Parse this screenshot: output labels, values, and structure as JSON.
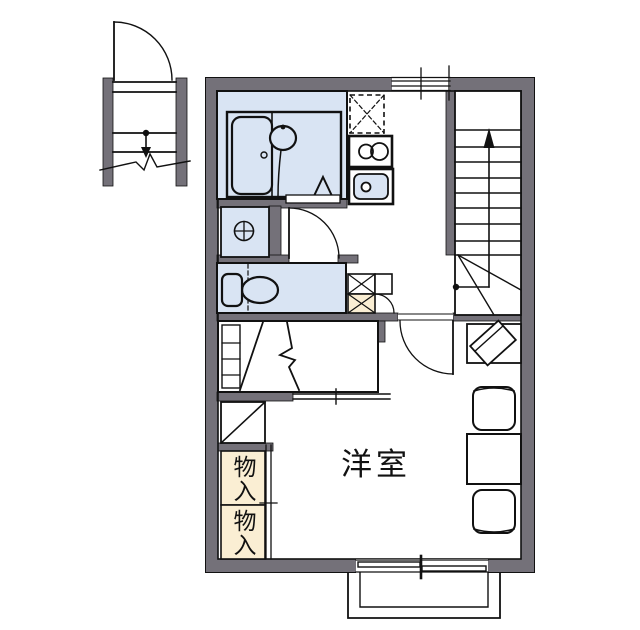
{
  "plan": {
    "labels": {
      "main_room": "洋室",
      "storage_upper": "物入",
      "storage_lower": "物入"
    },
    "colors": {
      "wall": "#747179",
      "wet_area": "#d9e4f3",
      "storage": "#faeed3",
      "line": "#111111",
      "background": "#ffffff"
    },
    "symbols": [
      "exterior-staircase-down-arrow",
      "entry-door-swing",
      "bathtub",
      "washbasin",
      "bath-triangle-symbol",
      "refrigerator-space-dashed",
      "two-burner-stove",
      "kitchen-sink",
      "washing-machine-pan",
      "toilet",
      "hall-storage-cabinet",
      "interior-staircase-up-arrow",
      "room-door-swing",
      "closet-with-ladder",
      "sliding-doors",
      "tv-stand",
      "dining-table",
      "chair",
      "balcony",
      "sliding-window"
    ]
  }
}
